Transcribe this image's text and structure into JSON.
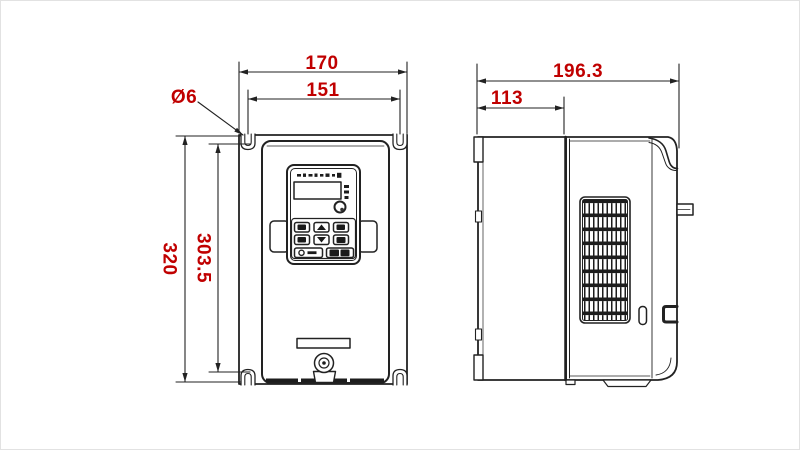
{
  "colors": {
    "dimension": "#c00000",
    "line": "#222222",
    "background": "#ffffff"
  },
  "front_view": {
    "overall_width_mm": "170",
    "mount_hole_spacing_width_mm": "151",
    "mount_hole_diameter": "Ø6",
    "overall_height_mm": "320",
    "mount_hole_spacing_height_mm": "303.5"
  },
  "side_view": {
    "overall_depth_mm": "196.3",
    "front_section_depth_mm": "113"
  }
}
